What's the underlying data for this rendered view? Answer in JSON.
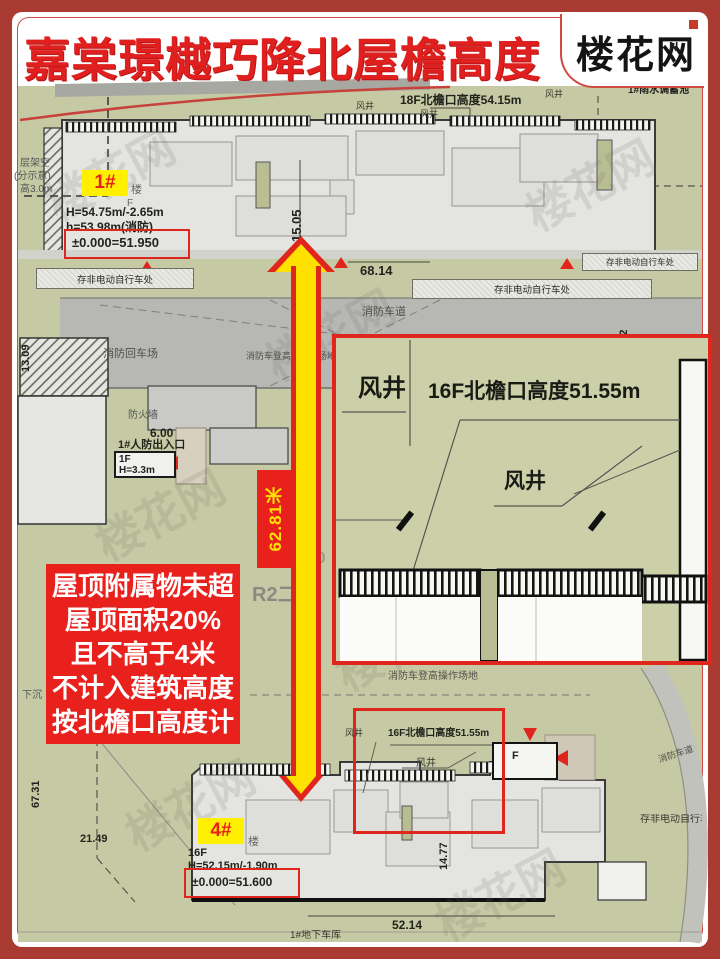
{
  "header": {
    "title": "嘉棠璟樾巧降北屋檐高度",
    "logo": "楼花网",
    "compass": "N"
  },
  "colors": {
    "frame_red": "#a93b32",
    "title_red": "#e01f1f",
    "annotation_red": "#e8211d",
    "badge_yellow": "#ffef00",
    "arrow_yellow": "#ffe100",
    "plan_green": "#c6caa4",
    "road_gray": "#b7b7b3"
  },
  "building1": {
    "badge": "1#",
    "name_suffix": "楼",
    "floor_suffix": "F",
    "height": "H=54.75m/-2.65m",
    "fire_height": "h=53.98m(消防)",
    "level": "±0.000=51.950"
  },
  "building4": {
    "badge": "4#",
    "name_suffix": "楼",
    "floors": "16F",
    "height": "H=52.15m/-1.90m",
    "level": "±0.000=51.600"
  },
  "note": {
    "lines": [
      "屋顶附属物未超",
      "屋顶面积20%",
      "且不高于4米",
      "不计入建筑高度",
      "按北檐口高度计"
    ]
  },
  "arrow": {
    "label": "62.81米"
  },
  "inset": {
    "shaft_left": "风井",
    "eave": "16F北檐口高度51.55m",
    "shaft_mid": "风井"
  },
  "detail": {
    "shaft_left": "风井",
    "eave": "16F北檐口高度51.55m",
    "shaft_mid": "风井",
    "entrance": "F"
  },
  "labels": {
    "rain_tank": "1#雨水调蓄池",
    "eave_top": "18F北檐口高度54.15m",
    "shaft_small_1": "风井",
    "shaft_small_2": "风井",
    "shaft_small_3": "风井",
    "bike_top_left": "存非电动自行车处",
    "bike_mid": "存非电动自行车处",
    "bike_right": "存非电动自行车处",
    "bike_bottom_right": "存非电动自行车处",
    "fire_lane": "消防车道",
    "fire_lane_right": "消防车道",
    "fire_turnaround": "消防回车场",
    "fire_platform_mid": "消防车登高面操作场地",
    "fire_platform_bottom": "消防车登高操作场地",
    "firewall": "防火墙",
    "civil_defense_title": "1#人防出入口",
    "civil_defense_floor": "1F",
    "civil_defense_height": "H=3.3m",
    "stilt_line1": "层架空",
    "stilt_line2": "(分示意)",
    "stilt_line3": "高3.0m",
    "sunken": "下沉",
    "zone_r2": "R2二类",
    "cad_text": "D0 L0",
    "garage": "1#地下车库"
  },
  "dims": {
    "v15": "15.05",
    "h68": "68.14",
    "v13a": "13.09",
    "v13b": "13.02",
    "h6": "6.00",
    "v67": "67.31",
    "h21": "21.49",
    "v14": "14.77",
    "h52": "52.14"
  },
  "watermark": "楼花网"
}
